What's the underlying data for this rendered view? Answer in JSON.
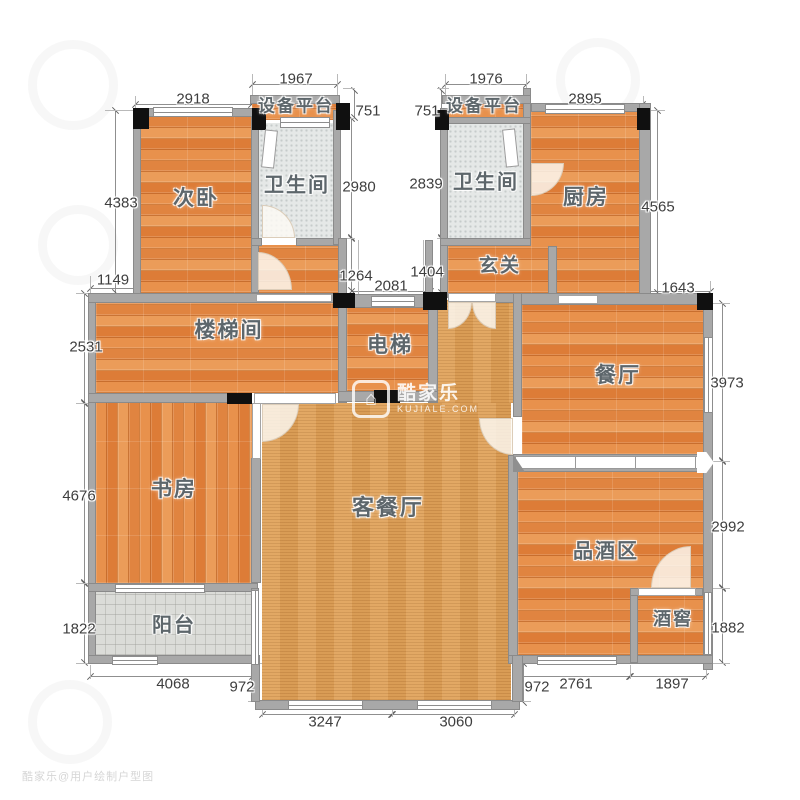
{
  "meta": {
    "type": "residential floor plan",
    "language": "zh-CN"
  },
  "rooms": {
    "bedroom2": "次卧",
    "equip_left": "设备平台",
    "bath_left": "卫生间",
    "equip_right": "设备平台",
    "bath_right": "卫生间",
    "kitchen": "厨房",
    "entry": "玄关",
    "stairwell": "楼梯间",
    "elevator": "电梯",
    "dining": "餐厅",
    "study": "书房",
    "living_dining": "客餐厅",
    "wine_tasting": "品酒区",
    "wine_cellar": "酒窖",
    "balcony": "阳台"
  },
  "dims": {
    "d1967": "1967",
    "d2918": "2918",
    "d1976": "1976",
    "d2895": "2895",
    "d751L": "751",
    "d751R": "751",
    "d4383": "4383",
    "d1149": "1149",
    "d2531": "2531",
    "d4676": "4676",
    "d1822": "1822",
    "d2980": "2980",
    "d1264": "1264",
    "d2081": "2081",
    "d2839": "2839",
    "d1404": "1404",
    "d4565": "4565",
    "d1643": "1643",
    "d3973": "3973",
    "d2992": "2992",
    "d1882": "1882",
    "d4068": "4068",
    "d972L": "972",
    "d3247": "3247",
    "d3060": "3060",
    "d972R": "972",
    "d2761": "2761",
    "d1897": "1897"
  },
  "watermark": {
    "brand": "酷家乐",
    "site": "KUJIALE.COM",
    "logo_glyph": "⌂",
    "corner": "酷家乐@用户绘制户型图"
  },
  "colors": {
    "floor_plank": "#e08440",
    "floor_hall": "#e0a158",
    "floor_tile": "#e5e8e7",
    "floor_balcony": "#dbdcd8",
    "wall": "#a8a8a8",
    "pillar": "#101010",
    "dim_text": "#3e3e3e",
    "label_text": "#5d666b"
  }
}
